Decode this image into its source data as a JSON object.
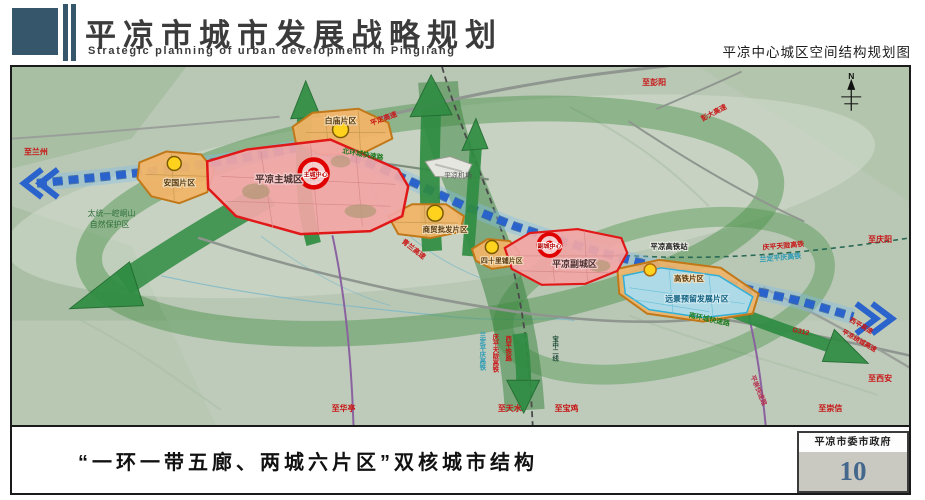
{
  "header": {
    "title": "平凉市城市发展战略规划",
    "subtitle": "Strategic planning of urban development in Pingliang",
    "map_title": "平凉中心城区空间结构规划图"
  },
  "footer": {
    "caption": "“一环一带五廊、两城六片区”双核城市结构",
    "org": "平凉市委市政府",
    "page_number": "10"
  },
  "map": {
    "compass_n": "N",
    "city_main": {
      "name": "平凉主城区",
      "core": "主城中心"
    },
    "city_sub": {
      "name": "平凉副城区",
      "core": "副城中心"
    },
    "districts": {
      "baimiao": "白庙片区",
      "anguo": "安国片区",
      "shangmao": "商贸批发片区",
      "sishilipu": "四十里铺片区",
      "gaotie": "高铁片区",
      "reserve": "远景预留发展片区"
    },
    "facilities": {
      "airport": "平凉机场",
      "hsr_station": "平凉高铁站"
    },
    "nature": {
      "line1": "太统—崆峒山",
      "line2": "自然保护区"
    },
    "roads": {
      "pingding": "平定高速",
      "qinglan": "青兰高速",
      "pengda": "彭大高速",
      "xiping_hw": "西平高速",
      "raocheng": "平凉绕城高速",
      "north_ring": "北环城快速路",
      "south_ring": "南环城快速路",
      "pingchong": "平崇快速路",
      "g312": "G312"
    },
    "rails": {
      "qingping_tianlong": "庆平天陇高铁",
      "landing_pingqing": "兰定平庆高铁",
      "xiping": "西平铁路",
      "baozhong": "宝中二线"
    },
    "directions": {
      "lanzhou": "至兰州",
      "pengyang": "至彭阳",
      "qingyang": "至庆阳",
      "huating": "至华亭",
      "tianshui": "至天水",
      "baoji": "至宝鸡",
      "xian": "至西安",
      "chongxin": "至崇信"
    },
    "colors": {
      "city_fill": "#f2a6a6",
      "city_border": "#e01818",
      "district_fill": "#f1b468",
      "district_border": "#c07818",
      "reserve_fill": "#abdcee",
      "corridor_green": "#2f8c42",
      "axis_blue": "#2a63cc",
      "node_yellow": "#ffd21e"
    }
  }
}
